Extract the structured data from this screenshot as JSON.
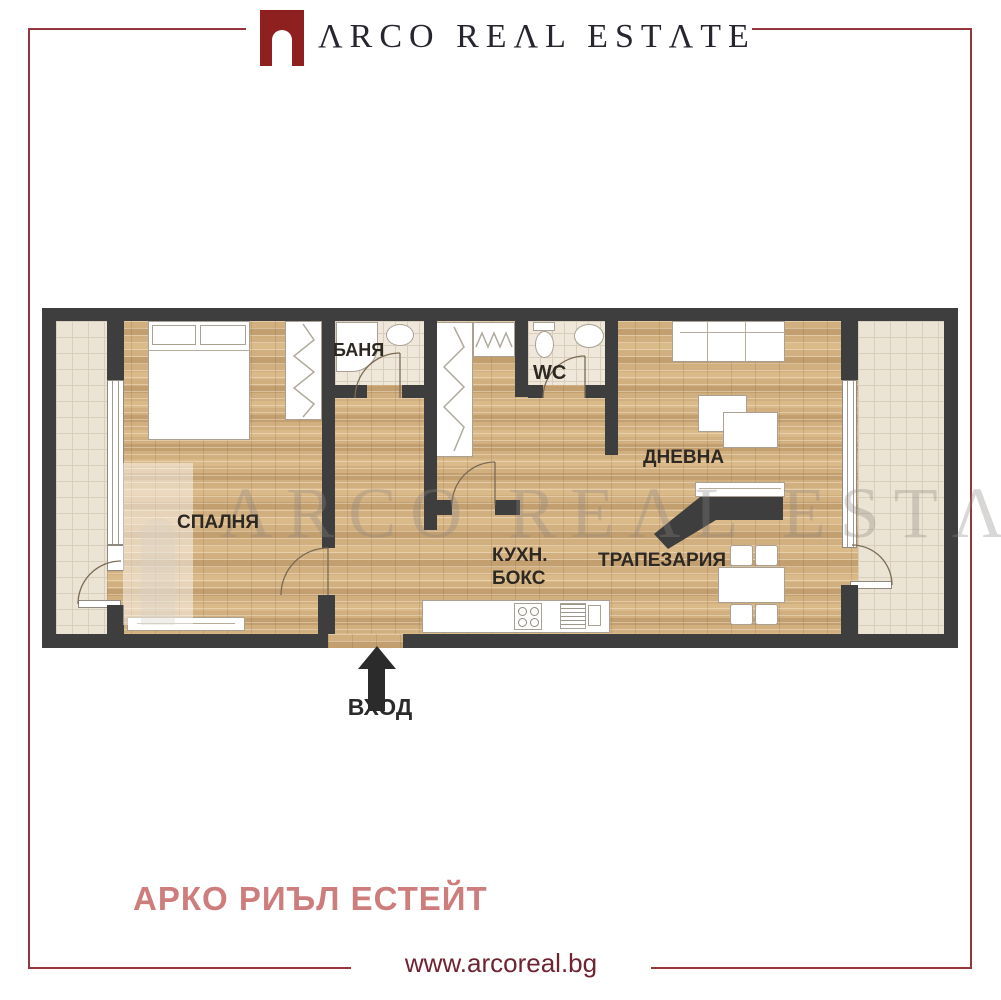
{
  "header": {
    "brand": "ΛRCO REΛL ESTΛTE"
  },
  "plan": {
    "rooms": {
      "bedroom": "СПАЛНЯ",
      "bathroom": "БАНЯ",
      "wc": "WC",
      "living": "ДНЕВНА",
      "kitchen_line1": "КУХН.",
      "kitchen_line2": "БОКС",
      "dining": "ТРАПЕЗАРИЯ"
    },
    "entrance_label": "ВХОД",
    "watermark": "ΛRCO REΛL ESTΛTE"
  },
  "footer": {
    "agency_name": "АРКО РИЪЛ ЕСТЕЙТ",
    "website": "www.arcoreal.bg"
  },
  "colors": {
    "brand_red": "#8e2020",
    "frame_red": "#95383e",
    "agency_pink": "#ce7d7d",
    "website_maroon": "#6e2431",
    "wall_dark": "#3e3e3e",
    "wood_floor": "#d2af7f",
    "tile_floor": "#ebe3d3",
    "label_dark": "#2e2823"
  }
}
